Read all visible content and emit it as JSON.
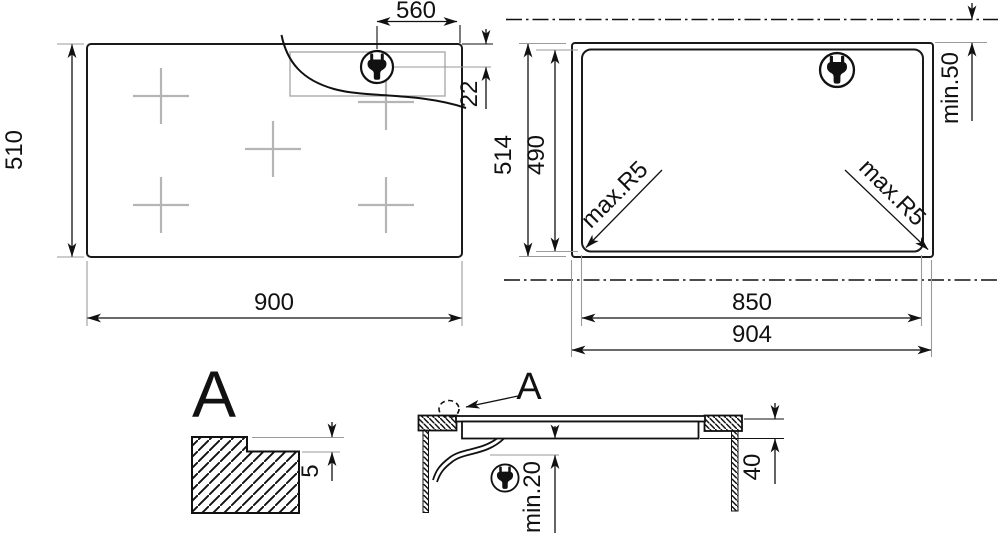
{
  "diagram_title": "hob installation dimensions drawing",
  "view_top_left": {
    "name": "hob top view with power connection position",
    "dim_width": "900",
    "dim_height": "510",
    "dim_plug_from_right": "560",
    "dim_plug_from_top": "22"
  },
  "view_top_right": {
    "name": "worktop cutout view",
    "dim_overall_width": "904",
    "dim_cutout_width": "850",
    "dim_overall_height": "514",
    "dim_cutout_height": "490",
    "dim_wall_clearance": "min.50",
    "dim_corner_radius_left": "max.R5",
    "dim_corner_radius_right": "max.R5"
  },
  "view_detail": {
    "label": "A",
    "dim_recess_depth": "5"
  },
  "view_section": {
    "label": "A",
    "dim_hob_height": "40",
    "dim_bottom_clearance": "min.20"
  },
  "icons": {
    "plug": "power-plug-icon",
    "detail_marker": "detail-a-dashed-circle"
  },
  "colors": {
    "line": "#111111",
    "thin_gray": "#9a9a9a",
    "burner_cross": "#b5b5b5",
    "background": "#ffffff"
  }
}
